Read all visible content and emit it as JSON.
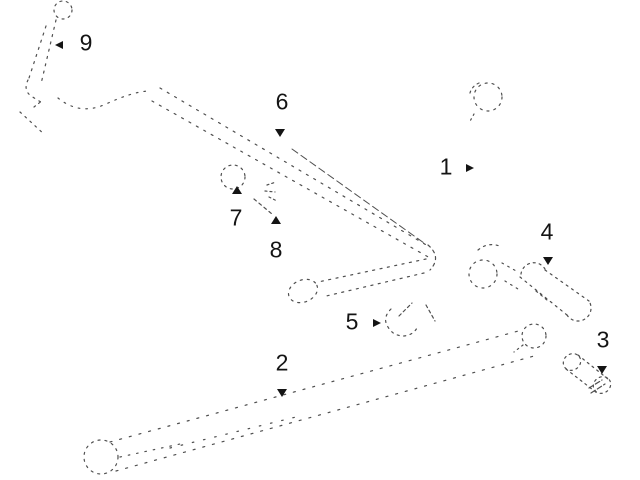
{
  "figure": {
    "type": "exploded-parts-line-diagram",
    "background_color": "#ffffff",
    "line_color": "#4f4f4f",
    "label_color": "#141414",
    "callouts": [
      {
        "label": "1",
        "text_x": 446,
        "text_y": 167,
        "arrow_x": 470,
        "arrow_y": 168,
        "arrow_dir": "right"
      },
      {
        "label": "2",
        "text_x": 282,
        "text_y": 363,
        "arrow_x": 282,
        "arrow_y": 393,
        "arrow_dir": "down"
      },
      {
        "label": "3",
        "text_x": 603,
        "text_y": 340,
        "arrow_x": 602,
        "arrow_y": 370,
        "arrow_dir": "down"
      },
      {
        "label": "4",
        "text_x": 547,
        "text_y": 232,
        "arrow_x": 548,
        "arrow_y": 261,
        "arrow_dir": "down"
      },
      {
        "label": "5",
        "text_x": 352,
        "text_y": 322,
        "arrow_x": 377,
        "arrow_y": 323,
        "arrow_dir": "right"
      },
      {
        "label": "6",
        "text_x": 282,
        "text_y": 102,
        "arrow_x": 280,
        "arrow_y": 133,
        "arrow_dir": "down"
      },
      {
        "label": "7",
        "text_x": 236,
        "text_y": 218,
        "arrow_x": 237,
        "arrow_y": 190,
        "arrow_dir": "up"
      },
      {
        "label": "8",
        "text_x": 276,
        "text_y": 250,
        "arrow_x": 276,
        "arrow_y": 220,
        "arrow_dir": "up"
      },
      {
        "label": "9",
        "text_x": 86,
        "text_y": 43,
        "arrow_x": 59,
        "arrow_y": 45,
        "arrow_dir": "left"
      }
    ]
  }
}
